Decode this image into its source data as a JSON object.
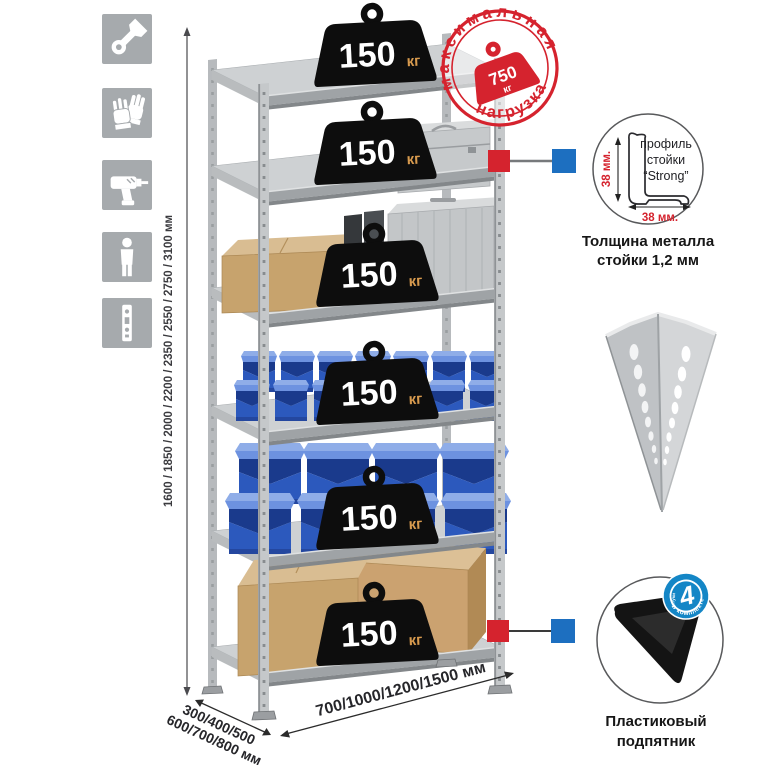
{
  "page": {
    "background": "#ffffff"
  },
  "colors": {
    "accent_red": "#d5232e",
    "accent_blue": "#1d6fc0",
    "icon_tile_gray": "#a6aaad",
    "metal_light": "#d6d8da",
    "metal_mid": "#aeb1b4",
    "metal_dark": "#8b8f92",
    "bin_blue": "#2c59bd",
    "bin_blue_dark": "#1a3a8c",
    "cardboard": "#c7a36d",
    "badge_black": "#0d0d0d",
    "badge_unit_color": "#d79a4e",
    "kit_badge_blue": "#1486c6",
    "foot_black": "#141414"
  },
  "left_icons": [
    {
      "name": "wrench-icon"
    },
    {
      "name": "gloves-icon"
    },
    {
      "name": "drill-icon"
    },
    {
      "name": "person-icon"
    },
    {
      "name": "upright-profile-icon"
    }
  ],
  "height_dimension": {
    "label": "1600 / 1850 / 2000 / 2200 / 2350 / 2550 / 2750 / 3100 мм"
  },
  "shelf_loads": [
    {
      "value": "150",
      "unit": "кг"
    },
    {
      "value": "150",
      "unit": "кг"
    },
    {
      "value": "150",
      "unit": "кг"
    },
    {
      "value": "150",
      "unit": "кг"
    },
    {
      "value": "150",
      "unit": "кг"
    },
    {
      "value": "150",
      "unit": "кг"
    }
  ],
  "max_load_stamp": {
    "arc_top": "максимальная",
    "arc_bottom": "нагрузка",
    "value": "750",
    "unit": "кг"
  },
  "profile_detail": {
    "vertical_dim": "38 мм.",
    "horizontal_dim": "38 мм.",
    "label_line1": "профиль",
    "label_line2": "стойки",
    "label_line3": "“Strong”",
    "caption_line1": "Толщина металла",
    "caption_line2": "стойки 1,2 мм"
  },
  "kit_badge": {
    "value": "4",
    "small_word": "штуки",
    "arc_text": "в комплекте"
  },
  "foot_detail": {
    "caption_line1": "Пластиковый",
    "caption_line2": "подпятник"
  },
  "width_dimension": {
    "label": "700/1000/1200/1500 мм"
  },
  "depth_dimension": {
    "line1": "300/400/500",
    "line2": "600/700/800 мм"
  }
}
